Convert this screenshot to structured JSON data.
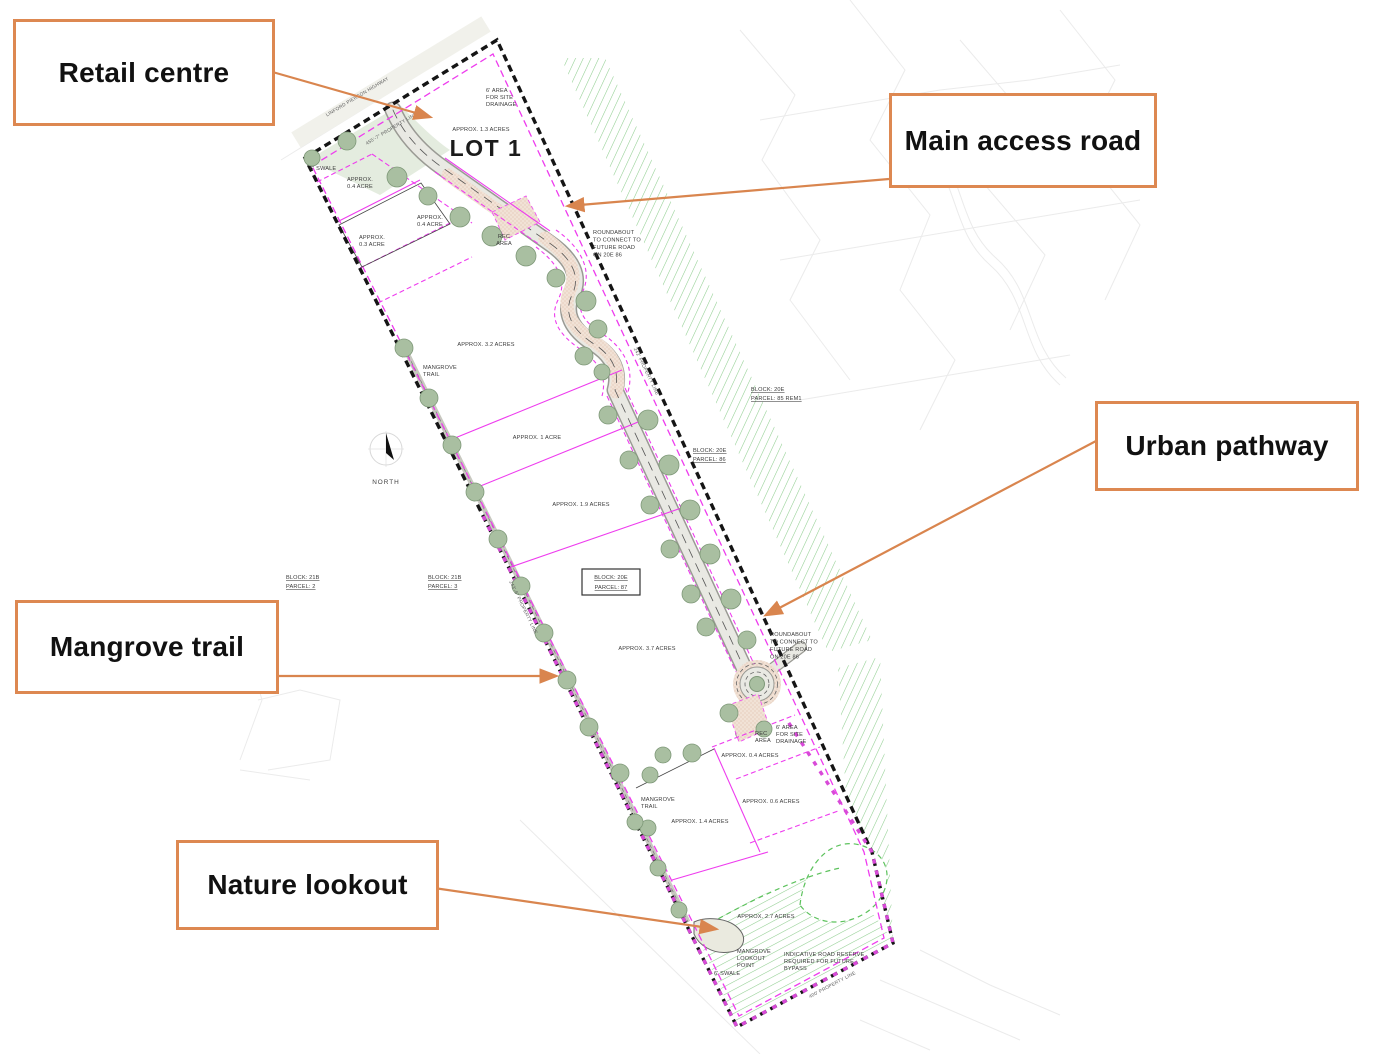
{
  "colors": {
    "callout_border": "#DD8851",
    "connector_orange": "#D9854E",
    "parcel_magenta": "#EE3CEE",
    "boundary_black": "#151515",
    "boundary_magenta": "#D84AD8",
    "tree_green": "#A9BFA1",
    "hatch_green": "#8FCD8F",
    "road_fill": "#E9E9E3",
    "stipple_pink": "#F1E2D6"
  },
  "callouts": {
    "retail": {
      "label": "Retail centre"
    },
    "main_access": {
      "label": "Main access road"
    },
    "urban_pathway": {
      "label": "Urban pathway"
    },
    "mangrove_trail": {
      "label": "Mangrove trail"
    },
    "nature_lookout": {
      "label": "Nature lookout"
    }
  },
  "plan": {
    "lot_title": "LOT 1",
    "north_label": "NORTH",
    "labels": [
      {
        "t": "LINFORD PIERSON HIGHWAY"
      },
      {
        "t": "455'-7\" PROPERTY LINE"
      },
      {
        "t": "6' AREA"
      },
      {
        "t": "FOR SITE"
      },
      {
        "t": "DRAINAGE"
      },
      {
        "t": "APPROX. 1.3 ACRES"
      },
      {
        "t": "6' SWALE"
      },
      {
        "t": "APPROX."
      },
      {
        "t": "0.4 ACRE"
      },
      {
        "t": "APPROX."
      },
      {
        "t": "0.4 ACRE"
      },
      {
        "t": "APPROX."
      },
      {
        "t": "0.3 ACRE"
      },
      {
        "t": "REC"
      },
      {
        "t": "AREA"
      },
      {
        "t": "ROUNDABOUT"
      },
      {
        "t": "TO CONNECT TO"
      },
      {
        "t": "FUTURE ROAD"
      },
      {
        "t": "ON 20E 86"
      },
      {
        "t": "BLOCK: 20E"
      },
      {
        "t": "PARCEL: 85 REM1"
      },
      {
        "t": "BLOCK: 20E"
      },
      {
        "t": "PARCEL: 86"
      },
      {
        "t": "APPROX. 3.2 ACRES"
      },
      {
        "t": "MANGROVE"
      },
      {
        "t": "TRAIL"
      },
      {
        "t": "APPROX. 1 ACRE"
      },
      {
        "t": "APPROX. 1.9 ACRES"
      },
      {
        "t": "BLOCK: 21B"
      },
      {
        "t": "PARCEL: 2"
      },
      {
        "t": "BLOCK: 21B"
      },
      {
        "t": "PARCEL: 3"
      },
      {
        "t": "BLOCK: 20E"
      },
      {
        "t": "PARCEL: 87"
      },
      {
        "t": "243'-6\" PROPERTY LINE"
      },
      {
        "t": "242' PROPERTY LINE"
      },
      {
        "t": "APPROX. 3.7 ACRES"
      },
      {
        "t": "ROUNDABOUT"
      },
      {
        "t": "TO CONNECT TO"
      },
      {
        "t": "FUTURE ROAD"
      },
      {
        "t": "ON 20E 86"
      },
      {
        "t": "REC"
      },
      {
        "t": "AREA"
      },
      {
        "t": "6' AREA"
      },
      {
        "t": "FOR SITE"
      },
      {
        "t": "DRAINAGE"
      },
      {
        "t": "APPROX. 0.4 ACRES"
      },
      {
        "t": "MANGROVE"
      },
      {
        "t": "TRAIL"
      },
      {
        "t": "APPROX. 0.6 ACRES"
      },
      {
        "t": "APPROX. 1.4 ACRES"
      },
      {
        "t": "APPROX. 2.7 ACRES"
      },
      {
        "t": "MANGROVE"
      },
      {
        "t": "LOOKOUT"
      },
      {
        "t": "POINT"
      },
      {
        "t": "6' SWALE"
      },
      {
        "t": "INDICATIVE ROAD RESERVE"
      },
      {
        "t": "REQUIRED FOR FUTURE"
      },
      {
        "t": "BYPASS"
      },
      {
        "t": "400' PROPERTY LINE"
      }
    ]
  }
}
